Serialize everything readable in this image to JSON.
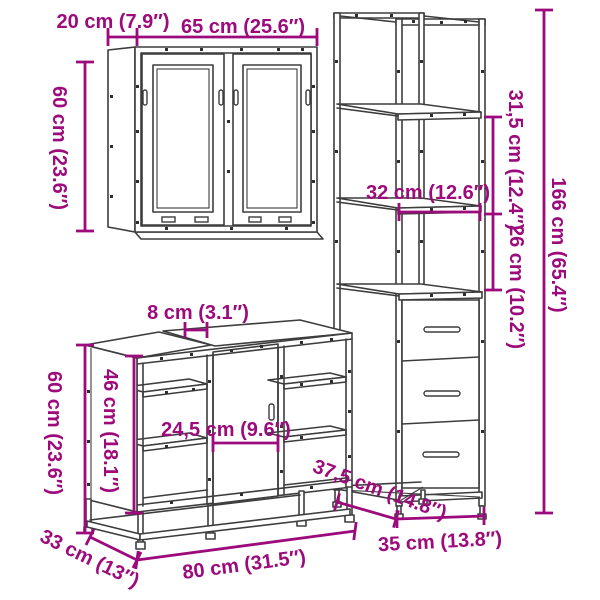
{
  "image_type": "furniture-dimension-diagram",
  "colors": {
    "background": "#ffffff",
    "dimension_annotations": "#9d0a7c",
    "furniture_line_art": "#3d3d3d"
  },
  "pieces": {
    "wall_cabinet": "wall cabinet with two mirror doors",
    "tall_cabinet": "tall cabinet with open shelves and three drawers",
    "sink_cabinet": "bathroom sink cabinet with door and open shelves"
  },
  "labels": {
    "wall_depth": "20 cm (7.9″)",
    "wall_width": "65 cm (25.6″)",
    "wall_height": "60 cm (23.6″)",
    "tall_upper_section": "31,5 cm (12.4″)",
    "tall_shelf_depth": "32 cm (12.6″)",
    "tall_middle_section": "26 cm (10.2″)",
    "tall_height": "166 cm (65.4″)",
    "tall_depth": "37,5 cm (14.8″)",
    "tall_width": "35 cm (13.8″)",
    "sink_gap": "8 cm (3.1″)",
    "sink_height": "60 cm (23.6″)",
    "sink_interior_height": "46 cm (18.1″)",
    "sink_door_width": "24,5 cm (9.6″)",
    "sink_depth": "33 cm (13″)",
    "sink_width": "80 cm (31.5″)"
  }
}
